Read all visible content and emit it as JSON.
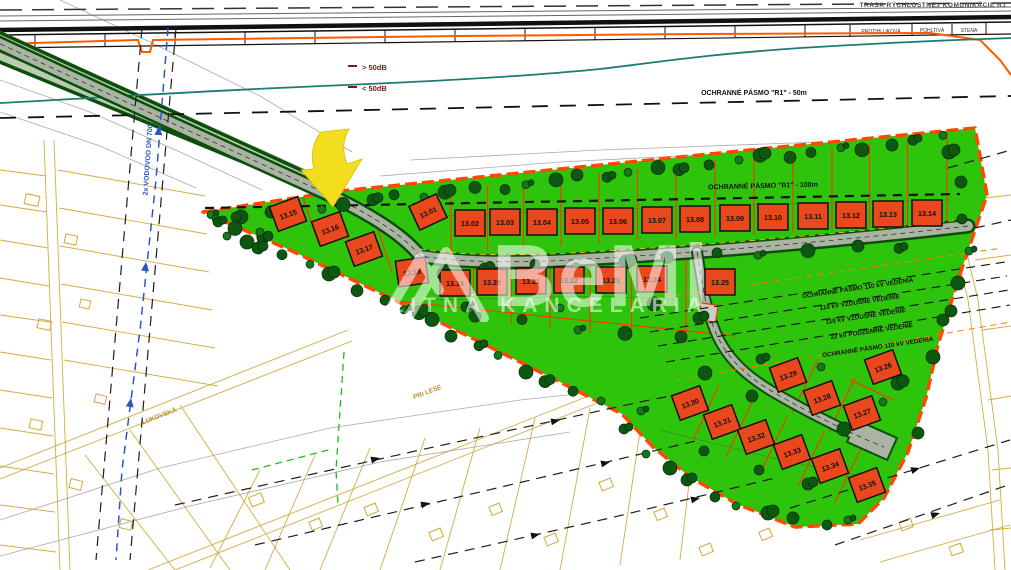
{
  "banner": {
    "route": "TRASA RÝCHLOSTNEJ KOMUNIKÁCIE R1",
    "wall": [
      "PROTIHLUKOVÁ",
      "POHLTIVÁ",
      "STENA"
    ]
  },
  "noise": {
    "above": "> 50dB",
    "below": "< 50dB"
  },
  "zones": {
    "r50": "OCHRANNÉ PÁSMO \"R1\" - 50m",
    "r100": "OCHRANNÉ PÁSMO \"R1\" - 100m"
  },
  "power": [
    "OCHRANNÉ PÁSMO 110 kV VEDENIA",
    "110 kV VZDUŠNÉ VEDENIE",
    "110 kV VZDUŠNÉ VEDENIE",
    "22 kV PODZEMNÉ VEDENIE",
    "OCHRANNÉ PÁSMO 110 kV VEDENIA"
  ],
  "water_label": "2x VODOVOD DN 700",
  "streets": {
    "lukovska": "LUKOVSKÁ",
    "prilese": "PRI LESE"
  },
  "watermark": {
    "brand": "BeMi",
    "subtitle": "REALITNÁ KANCELÁRIA"
  },
  "colors": {
    "site_green": "#2fc40c",
    "boundary_orange": "#ff4800",
    "house_red": "#e8481c",
    "tree_green": "#0d5711",
    "parcel_yellow": "#cfa93a",
    "noise_teal": "#1b7d74",
    "water_blue": "#2b56c4",
    "arrow_yellow": "#f2de1f"
  },
  "plots": [
    {
      "id": "13.01",
      "x": 428,
      "y": 212,
      "r": -25
    },
    {
      "id": "13.02",
      "x": 470,
      "y": 223,
      "r": 0
    },
    {
      "id": "13.03",
      "x": 505,
      "y": 222,
      "r": 0
    },
    {
      "id": "13.04",
      "x": 542,
      "y": 222,
      "r": 0
    },
    {
      "id": "13.05",
      "x": 580,
      "y": 221,
      "r": 0
    },
    {
      "id": "13.06",
      "x": 618,
      "y": 221,
      "r": 0
    },
    {
      "id": "13.07",
      "x": 657,
      "y": 220,
      "r": 0
    },
    {
      "id": "13.08",
      "x": 695,
      "y": 219,
      "r": 0
    },
    {
      "id": "13.09",
      "x": 735,
      "y": 218,
      "r": 0
    },
    {
      "id": "13.10",
      "x": 773,
      "y": 217,
      "r": 0
    },
    {
      "id": "13.11",
      "x": 813,
      "y": 216,
      "r": 0
    },
    {
      "id": "13.12",
      "x": 851,
      "y": 215,
      "r": 0
    },
    {
      "id": "13.13",
      "x": 888,
      "y": 214,
      "r": 0
    },
    {
      "id": "13.14",
      "x": 927,
      "y": 213,
      "r": 0
    },
    {
      "id": "13.15",
      "x": 288,
      "y": 214,
      "r": -20
    },
    {
      "id": "13.16",
      "x": 330,
      "y": 229,
      "r": -20
    },
    {
      "id": "13.17",
      "x": 364,
      "y": 249,
      "r": -20
    },
    {
      "id": "13.18",
      "x": 412,
      "y": 272,
      "r": -8
    },
    {
      "id": "13.19",
      "x": 455,
      "y": 283,
      "r": 0
    },
    {
      "id": "13.20",
      "x": 492,
      "y": 282,
      "r": 0
    },
    {
      "id": "13.21",
      "x": 531,
      "y": 281,
      "r": 0
    },
    {
      "id": "13.22",
      "x": 569,
      "y": 280,
      "r": 0
    },
    {
      "id": "13.23",
      "x": 611,
      "y": 280,
      "r": 0
    },
    {
      "id": "13.24",
      "x": 652,
      "y": 279,
      "r": 0
    },
    {
      "id": "13.25",
      "x": 720,
      "y": 282,
      "r": 0
    },
    {
      "id": "13.26",
      "x": 883,
      "y": 367,
      "r": -20
    },
    {
      "id": "13.27",
      "x": 862,
      "y": 413,
      "r": -20
    },
    {
      "id": "13.28",
      "x": 822,
      "y": 398,
      "r": -20
    },
    {
      "id": "13.29",
      "x": 788,
      "y": 375,
      "r": -20
    },
    {
      "id": "13.30",
      "x": 690,
      "y": 403,
      "r": -20
    },
    {
      "id": "13.31",
      "x": 722,
      "y": 422,
      "r": -20
    },
    {
      "id": "13.32",
      "x": 756,
      "y": 437,
      "r": -20
    },
    {
      "id": "13.33",
      "x": 792,
      "y": 452,
      "r": -20
    },
    {
      "id": "13.34",
      "x": 830,
      "y": 466,
      "r": -20
    },
    {
      "id": "13.35",
      "x": 867,
      "y": 485,
      "r": -20
    }
  ]
}
